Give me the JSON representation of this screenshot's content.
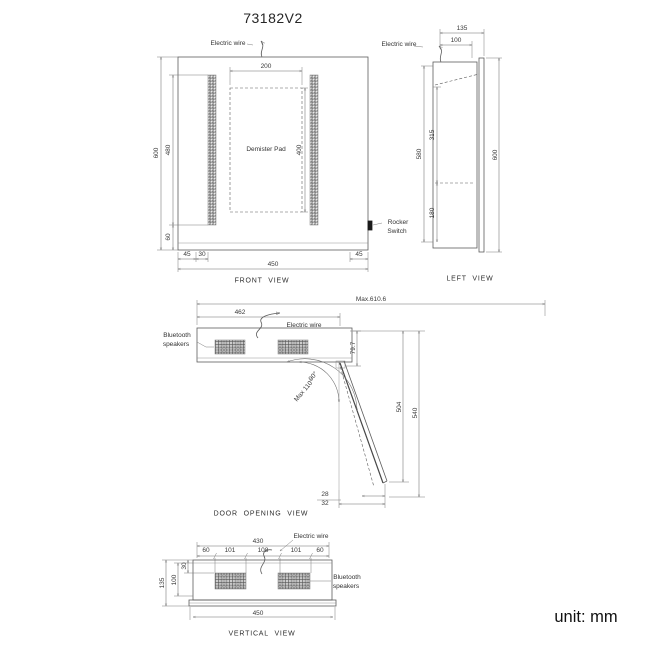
{
  "title": "73182V2",
  "unit_label": "unit: mm",
  "front_view": {
    "caption": "FRONT VIEW",
    "electric_wire_label": "Electric wire",
    "demister_pad_label": "Demister Pad",
    "rocker_switch_label_line1": "Rocker",
    "rocker_switch_label_line2": "Switch",
    "dims": {
      "overall_height": "600",
      "led_strip_height": "480",
      "bottom_margin": "60",
      "demister_width": "200",
      "demister_height": "400",
      "overall_width": "450",
      "left_margin": "45",
      "strip_inset": "30",
      "right_margin": "45"
    }
  },
  "left_view": {
    "caption": "LEFT VIEW",
    "electric_wire_label": "Electric wire",
    "dims": {
      "overall_depth": "135",
      "body_depth": "100",
      "body_height": "580",
      "upper_section": "315",
      "lower_section": "180",
      "overall_height": "600"
    }
  },
  "door_opening_view": {
    "caption": "DOOR OPENING VIEW",
    "electric_wire_label": "Electric wire",
    "bluetooth_label_line1": "Bluetooth",
    "bluetooth_label_line2": "speakers",
    "angle_90": "90°",
    "angle_max": "Max 110°",
    "dims": {
      "max_extension": "Max.610.6",
      "body_width": "462",
      "hinge_offset": "79.7",
      "door_reach": "504",
      "total_reach": "540",
      "tip_offset_upper": "28",
      "tip_offset_lower": "32"
    }
  },
  "vertical_view": {
    "caption": "VERTICAL VIEW",
    "electric_wire_label": "Electric wire",
    "bluetooth_label_line1": "Bluetooth",
    "bluetooth_label_line2": "speakers",
    "dims": {
      "top_width": "430",
      "seg_1": "60",
      "seg_2": "101",
      "seg_3": "108",
      "seg_4": "101",
      "seg_5": "60",
      "speaker_offset": "30",
      "inner_depth": "100",
      "overall_depth": "135",
      "base_width": "450"
    }
  }
}
